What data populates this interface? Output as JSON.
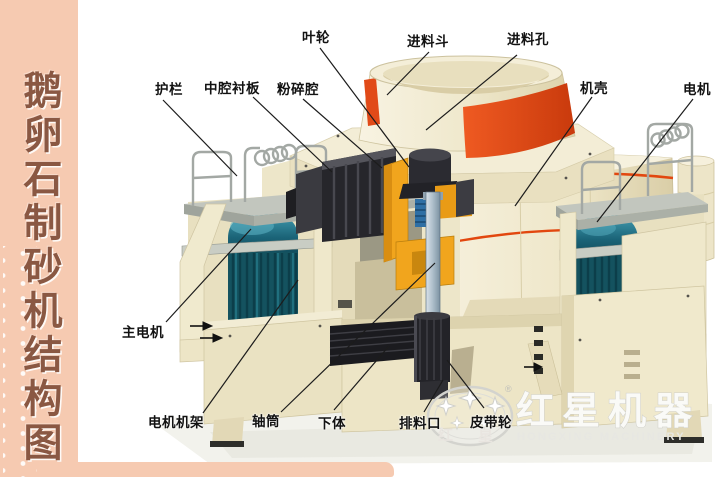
{
  "sidebar": {
    "title": "鹅卵石制砂机结构图"
  },
  "labels": {
    "impeller": "叶轮",
    "feed_hopper": "进料斗",
    "feed_hole": "进料孔",
    "guardrail": "护栏",
    "cavity_liner": "中腔衬板",
    "crushing_cavity": "粉碎腔",
    "casing": "机壳",
    "motor": "电机",
    "main_motor": "主电机",
    "motor_frame": "电机机架",
    "shaft_tube": "轴筒",
    "lower_body": "下体",
    "discharge_port": "排料口",
    "belt_pulley": "皮带轮"
  },
  "watermark": {
    "brand_cn": "红星机器",
    "brand_en": "HONGXING MACHINERY",
    "seal_left": "红",
    "seal_right": "星",
    "registered": "®"
  },
  "colors": {
    "sidebar_bg": "#F6CAB1",
    "sidebar_text": "#8A5843",
    "machine_cream": "#F0E9CE",
    "accent_red": "#E2470F",
    "motor_teal": "#1B6478",
    "impeller_orange": "#F1A51D"
  }
}
